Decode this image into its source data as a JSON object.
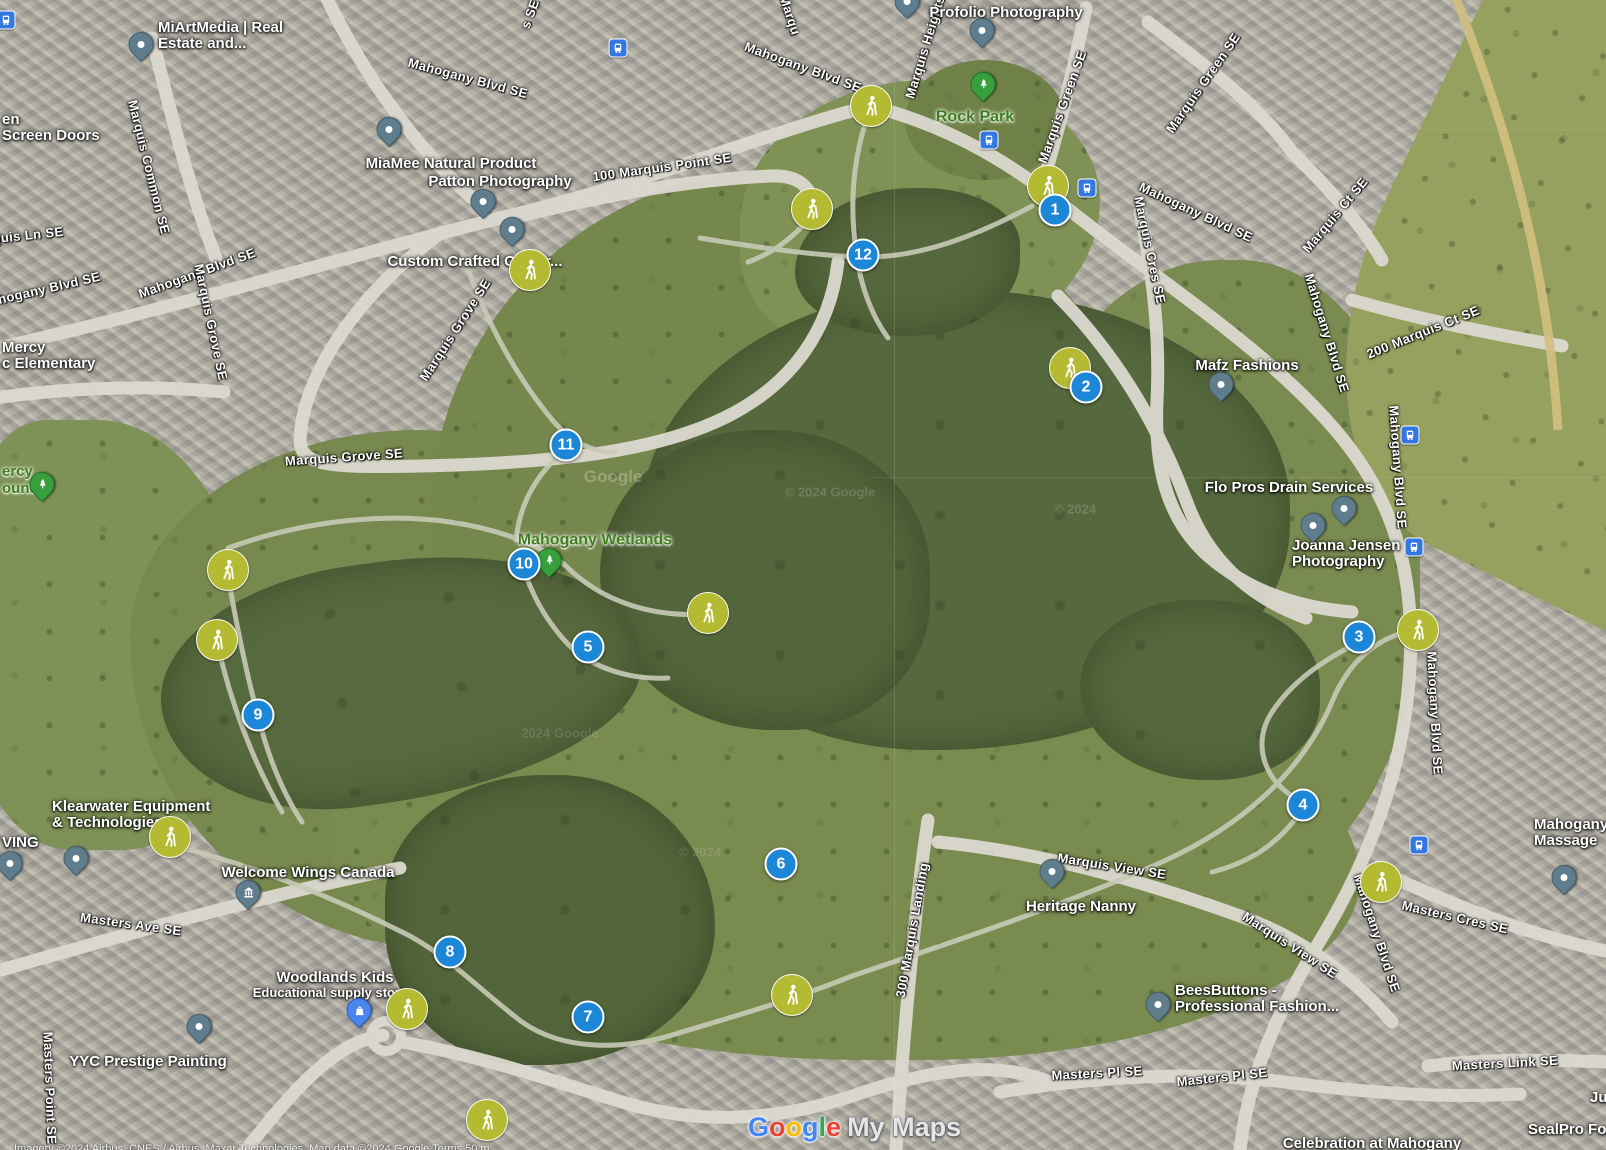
{
  "watermark": {
    "google": "Google",
    "my_maps": "My Maps"
  },
  "attribution": "Imagery ©2024 Airbus, CNES / Airbus, Maxar Technologies, Map data ©2024 Google   Terms   50 m",
  "colors": {
    "marker_blue": "#1B87D6",
    "trail_olive": "#B5BA33",
    "pin_slate": "#5F7D8C",
    "tree_green": "#37A03C",
    "bus_blue": "#3577E0",
    "park_label_green": "#3E7F1E",
    "google_blue": "#4285F4",
    "google_red": "#EA4335",
    "google_yellow": "#FBBC05",
    "google_green": "#34A853"
  },
  "numbered_markers": [
    {
      "n": "1",
      "x": 1055,
      "y": 210
    },
    {
      "n": "2",
      "x": 1086,
      "y": 387
    },
    {
      "n": "3",
      "x": 1359,
      "y": 637
    },
    {
      "n": "4",
      "x": 1303,
      "y": 805
    },
    {
      "n": "5",
      "x": 588,
      "y": 647
    },
    {
      "n": "6",
      "x": 781,
      "y": 864
    },
    {
      "n": "7",
      "x": 588,
      "y": 1017
    },
    {
      "n": "8",
      "x": 450,
      "y": 952
    },
    {
      "n": "9",
      "x": 258,
      "y": 715
    },
    {
      "n": "10",
      "x": 524,
      "y": 564
    },
    {
      "n": "11",
      "x": 566,
      "y": 445
    },
    {
      "n": "12",
      "x": 863,
      "y": 255
    }
  ],
  "trail_icons": [
    {
      "x": 871,
      "y": 106
    },
    {
      "x": 812,
      "y": 209
    },
    {
      "x": 1048,
      "y": 186
    },
    {
      "x": 530,
      "y": 270
    },
    {
      "x": 1070,
      "y": 368
    },
    {
      "x": 1418,
      "y": 630
    },
    {
      "x": 1381,
      "y": 882
    },
    {
      "x": 228,
      "y": 570
    },
    {
      "x": 217,
      "y": 640
    },
    {
      "x": 170,
      "y": 837
    },
    {
      "x": 407,
      "y": 1009
    },
    {
      "x": 487,
      "y": 1120
    },
    {
      "x": 792,
      "y": 995
    },
    {
      "x": 708,
      "y": 613
    }
  ],
  "bus_stops": [
    {
      "x": 6,
      "y": 20
    },
    {
      "x": 618,
      "y": 48
    },
    {
      "x": 989,
      "y": 140
    },
    {
      "x": 1087,
      "y": 188
    },
    {
      "x": 1410,
      "y": 435
    },
    {
      "x": 1414,
      "y": 547
    },
    {
      "x": 1419,
      "y": 845
    }
  ],
  "tree_pins": [
    {
      "x": 983,
      "y": 87
    },
    {
      "x": 549,
      "y": 563
    },
    {
      "x": 42,
      "y": 487
    }
  ],
  "poi_pins": [
    {
      "x": 141,
      "y": 47
    },
    {
      "x": 389,
      "y": 132
    },
    {
      "x": 483,
      "y": 204
    },
    {
      "x": 512,
      "y": 232
    },
    {
      "x": 982,
      "y": 33
    },
    {
      "x": 907,
      "y": 4
    },
    {
      "x": 1221,
      "y": 387
    },
    {
      "x": 1313,
      "y": 528
    },
    {
      "x": 1344,
      "y": 511
    },
    {
      "x": 1052,
      "y": 874
    },
    {
      "x": 1158,
      "y": 1007
    },
    {
      "x": 199,
      "y": 1029
    },
    {
      "x": 10,
      "y": 866
    },
    {
      "x": 76,
      "y": 861
    },
    {
      "x": 1564,
      "y": 880
    }
  ],
  "museum_pins": [
    {
      "x": 248,
      "y": 895
    }
  ],
  "store_pins": [
    {
      "x": 359,
      "y": 1013
    }
  ],
  "business_labels": [
    {
      "lines": [
        "MiArtMedia | Real",
        "Estate and..."
      ],
      "x": 158,
      "y": 36,
      "align": "left"
    },
    {
      "lines": [
        "MiaMee Natural Product"
      ],
      "x": 451,
      "y": 164
    },
    {
      "lines": [
        "Patton Photography"
      ],
      "x": 500,
      "y": 182
    },
    {
      "lines": [
        "Custom Crafted Calgar..."
      ],
      "x": 475,
      "y": 262
    },
    {
      "lines": [
        "Profolio Photography"
      ],
      "x": 1006,
      "y": 13
    },
    {
      "lines": [
        "en",
        "Screen Doors"
      ],
      "x": 2,
      "y": 128,
      "align": "left"
    },
    {
      "lines": [
        "Mercy",
        "c Elementary"
      ],
      "x": 2,
      "y": 356,
      "align": "left"
    },
    {
      "lines": [
        "VING"
      ],
      "x": 2,
      "y": 843,
      "align": "left"
    },
    {
      "lines": [
        "Klearwater Equipment",
        "& Technologies"
      ],
      "x": 52,
      "y": 815,
      "align": "left"
    },
    {
      "lines": [
        "Welcome Wings Canada"
      ],
      "x": 308,
      "y": 873
    },
    {
      "lines": [
        "Woodlands Kids"
      ],
      "x": 335,
      "y": 978
    },
    {
      "lines": [
        "Educational supply store"
      ],
      "x": 330,
      "y": 993,
      "size": 13
    },
    {
      "lines": [
        "YYC Prestige Painting"
      ],
      "x": 148,
      "y": 1062
    },
    {
      "lines": [
        "Heritage Nanny"
      ],
      "x": 1081,
      "y": 907
    },
    {
      "lines": [
        "BeesButtons -",
        "Professional Fashion..."
      ],
      "x": 1175,
      "y": 999,
      "align": "left"
    },
    {
      "lines": [
        "Mafz Fashions"
      ],
      "x": 1247,
      "y": 366
    },
    {
      "lines": [
        "Flo Pros Drain Services"
      ],
      "x": 1289,
      "y": 488
    },
    {
      "lines": [
        "Joanna Jensen",
        "Photography"
      ],
      "x": 1292,
      "y": 554,
      "align": "left"
    },
    {
      "lines": [
        "Mahogany",
        "Massage"
      ],
      "x": 1534,
      "y": 833,
      "align": "left"
    },
    {
      "lines": [
        "SealPro Foa"
      ],
      "x": 1528,
      "y": 1130,
      "align": "left"
    },
    {
      "lines": [
        "Ju"
      ],
      "x": 1590,
      "y": 1098,
      "align": "left"
    },
    {
      "lines": [
        "Celebration at Mahogany"
      ],
      "x": 1372,
      "y": 1144
    }
  ],
  "park_labels": [
    {
      "lines": [
        "Rock Park"
      ],
      "x": 975,
      "y": 117
    },
    {
      "lines": [
        "Mahogany Wetlands"
      ],
      "x": 595,
      "y": 540
    },
    {
      "lines": [
        "ercy",
        "ound"
      ],
      "x": 2,
      "y": 480,
      "align": "left",
      "size": 15
    }
  ],
  "street_labels": [
    {
      "t": "Mahogany Blvd SE",
      "x": 40,
      "y": 290,
      "r": -13
    },
    {
      "t": "Mahogany Blvd SE",
      "x": 197,
      "y": 273,
      "r": -20
    },
    {
      "t": "Mahogany Blvd SE",
      "x": 468,
      "y": 78,
      "r": 15
    },
    {
      "t": "Mahogany Blvd SE",
      "x": 803,
      "y": 67,
      "r": 20
    },
    {
      "t": "Mahogany Blvd SE",
      "x": 1196,
      "y": 212,
      "r": 25
    },
    {
      "t": "Mahogany Blvd SE",
      "x": 1327,
      "y": 333,
      "r": 73
    },
    {
      "t": "Mahogany Blvd SE",
      "x": 1398,
      "y": 467,
      "r": 86
    },
    {
      "t": "Mahogany Blvd SE",
      "x": 1435,
      "y": 713,
      "r": 87
    },
    {
      "t": "Mahogany Blvd SE",
      "x": 1377,
      "y": 933,
      "r": 72
    },
    {
      "t": "Marquis Common SE",
      "x": 149,
      "y": 167,
      "r": 76
    },
    {
      "t": "quis Ln SE",
      "x": 28,
      "y": 235,
      "r": -6
    },
    {
      "t": "100 Marquis Point SE",
      "x": 662,
      "y": 167,
      "r": -8
    },
    {
      "t": "Marquis Heights",
      "x": 925,
      "y": 47,
      "r": -73
    },
    {
      "t": "Marquis Green SE",
      "x": 1062,
      "y": 107,
      "r": -70
    },
    {
      "t": "Marquis Green SE",
      "x": 1203,
      "y": 83,
      "r": -55
    },
    {
      "t": "Marquis Grove SE",
      "x": 344,
      "y": 457,
      "r": -4
    },
    {
      "t": "Marquis Grove SE",
      "x": 455,
      "y": 330,
      "r": -57
    },
    {
      "t": "Marquis Grove SE",
      "x": 211,
      "y": 322,
      "r": 78
    },
    {
      "t": "Marquis Cres SE",
      "x": 1150,
      "y": 250,
      "r": 78
    },
    {
      "t": "Marquis Ct SE",
      "x": 1335,
      "y": 215,
      "r": -50
    },
    {
      "t": "200 Marquis Ct SE",
      "x": 1423,
      "y": 332,
      "r": -22
    },
    {
      "t": "Masters Ave SE",
      "x": 131,
      "y": 924,
      "r": 8
    },
    {
      "t": "Masters Point SE",
      "x": 50,
      "y": 1088,
      "r": 88
    },
    {
      "t": "300 Marquis Landing",
      "x": 912,
      "y": 930,
      "r": -80
    },
    {
      "t": "Marquis View SE",
      "x": 1112,
      "y": 866,
      "r": 9
    },
    {
      "t": "Marquis View SE",
      "x": 1290,
      "y": 945,
      "r": 33
    },
    {
      "t": "Masters Pl SE",
      "x": 1097,
      "y": 1073,
      "r": -3
    },
    {
      "t": "Masters Pl SE",
      "x": 1222,
      "y": 1077,
      "r": -6
    },
    {
      "t": "Masters Cres SE",
      "x": 1455,
      "y": 917,
      "r": 13
    },
    {
      "t": "Masters Link SE",
      "x": 1505,
      "y": 1063,
      "r": -3
    },
    {
      "t": "Marqu",
      "x": 790,
      "y": 15,
      "r": 72
    },
    {
      "t": "s SE",
      "x": 530,
      "y": 14,
      "r": -70
    }
  ],
  "ghost_marks": [
    {
      "t": "Google",
      "x": 613,
      "y": 477,
      "o": 0.25,
      "s": 17
    },
    {
      "t": "© 2024 Google",
      "x": 830,
      "y": 492,
      "o": 0.16,
      "s": 13
    },
    {
      "t": "© 2024",
      "x": 1075,
      "y": 509,
      "o": 0.16,
      "s": 13
    },
    {
      "t": "© 2024",
      "x": 700,
      "y": 852,
      "o": 0.13,
      "s": 13
    },
    {
      "t": "2024 Google",
      "x": 560,
      "y": 733,
      "o": 0.12,
      "s": 13
    }
  ]
}
